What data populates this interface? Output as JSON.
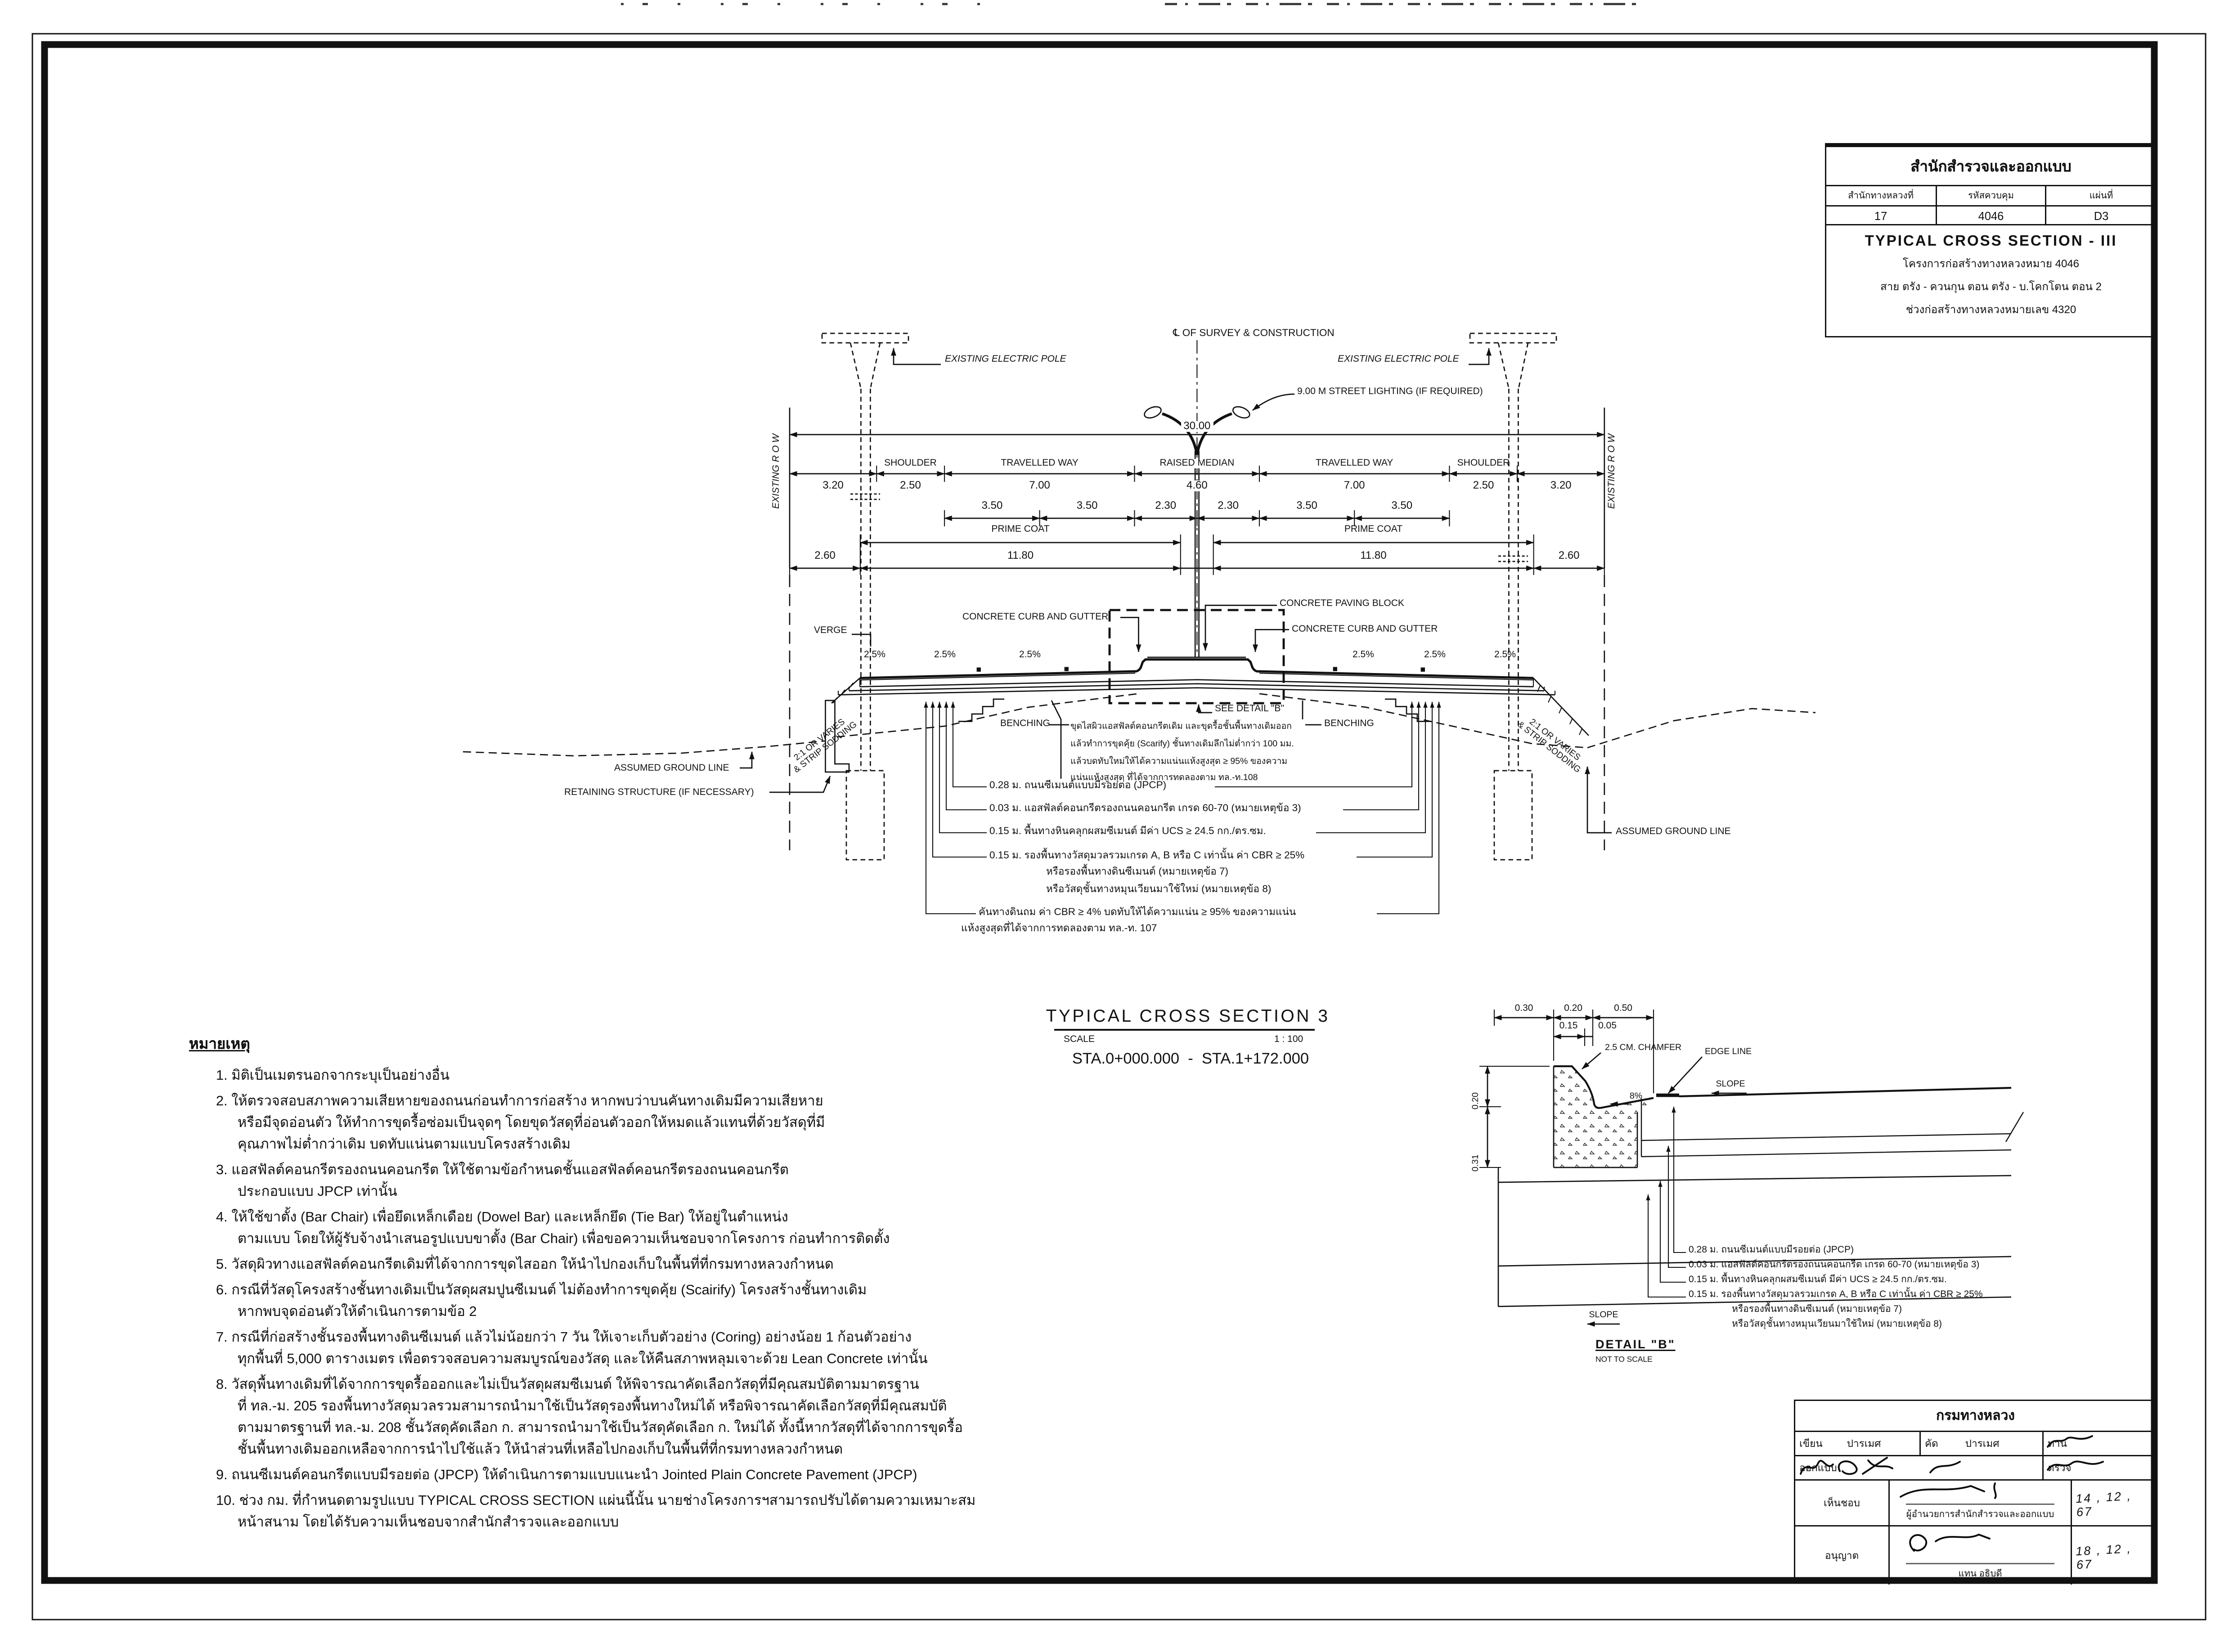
{
  "title_block": {
    "agency": "สำนักสำรวจและออกแบบ",
    "col1_label": "สำนักทางหลวงที่",
    "col1_value": "17",
    "col2_label": "รหัสควบคุม",
    "col2_value": "4046",
    "col3_label": "แผ่นที่",
    "col3_value": "D3",
    "drawing_title": "TYPICAL CROSS SECTION - III",
    "project_line1": "โครงการก่อสร้างทางหลวงหมาย 4046",
    "project_line2": "สาย ตรัง - ควนกุน ตอน ตรัง - บ.โคกโตน ตอน 2",
    "project_line3": "ช่วงก่อสร้างทางหลวงหมายเลข 4320"
  },
  "section": {
    "centerline_label": "℄ OF SURVEY & CONSTRUCTION",
    "row_label": "EXISTING R O W",
    "electric_pole_label": "EXISTING ELECTRIC POLE",
    "street_light_label": "9.00 M STREET LIGHTING (IF REQUIRED)",
    "labels": {
      "shoulder": "SHOULDER",
      "travelled_way": "TRAVELLED WAY",
      "raised_median": "RAISED MEDIAN",
      "prime_coat": "PRIME COAT",
      "verge": "VERGE",
      "benching": "BENCHING",
      "see_detail": "SEE DETAIL \"B\"",
      "slope_2_5": "2.5%",
      "slope_note": "2:1 OR VARIES\n& STRIP SODDING",
      "assumed_ground": "ASSUMED GROUND LINE",
      "retaining": "RETAINING STRUCTURE (IF NECESSARY)",
      "paving_block": "CONCRETE PAVING BLOCK",
      "curb_gutter": "CONCRETE CURB AND GUTTER"
    },
    "dims": {
      "total": "30.00",
      "d320": "3.20",
      "d250": "2.50",
      "d700": "7.00",
      "d460": "4.60",
      "d350": "3.50",
      "d230": "2.30",
      "d260": "2.60",
      "d1180": "11.80"
    },
    "scarify_note": "ขุดไสผิวแอสฟัลต์คอนกรีตเดิม และขุดรื้อชั้นพื้นทางเดิมออก\nแล้วทำการขุดคุ้ย (Scarify) ชั้นทางเดิมลึกไม่ต่ำกว่า 100 มม.\nแล้วบดทับใหม่ให้ได้ความแน่นแห้งสูงสุด ≥ 95% ของความ\nแน่นแห้งสูงสุด ที่ได้จากการทดลองตาม ทล.-ท.108",
    "layers": [
      {
        "d": "0.28 ม.",
        "t": "ถนนซีเมนต์แบบมีรอยต่อ (JPCP)"
      },
      {
        "d": "0.03 ม.",
        "t": "แอสฟัลต์คอนกรีตรองถนนคอนกรีต เกรด 60-70 (หมายเหตุข้อ 3)"
      },
      {
        "d": "0.15 ม.",
        "t": "พื้นทางหินคลุกผสมซีเมนต์ มีค่า UCS ≥ 24.5 กก./ตร.ซม."
      },
      {
        "d": "0.15 ม.",
        "t": "รองพื้นทางวัสดุมวลรวมเกรด A, B หรือ C เท่านั้น ค่า CBR ≥ 25%",
        "t2": "หรือรองพื้นทางดินซีเมนต์ (หมายเหตุข้อ 7)",
        "t3": "หรือวัสดุชั้นทางหมุนเวียนมาใช้ใหม่ (หมายเหตุข้อ 8)"
      },
      {
        "d": "",
        "t": "คันทางดินถม ค่า CBR ≥ 4% บดทับให้ได้ความแน่น ≥ 95% ของความแน่น",
        "t2": "แห้งสูงสุดที่ได้จากการทดลองตาม ทล.-ท. 107"
      }
    ]
  },
  "section_title": {
    "title": "TYPICAL CROSS SECTION 3",
    "scale_label": "SCALE",
    "scale_value": "1 : 100",
    "sta": "STA.0+000.000  -  STA.1+172.000"
  },
  "detail_b": {
    "dims": {
      "d030": "0.30",
      "d020": "0.20",
      "d050": "0.50",
      "d015": "0.15",
      "d005": "0.05",
      "v020": "0.20",
      "v031": "0.31"
    },
    "labels": {
      "chamfer": "2.5 CM. CHAMFER",
      "edge_line": "EDGE LINE",
      "slope": "SLOPE",
      "grade": "8%"
    },
    "name": "DETAIL \"B\"",
    "scale_note": "NOT TO SCALE"
  },
  "notes": {
    "heading": "หมายเหตุ",
    "items": [
      "1. มิติเป็นเมตรนอกจากระบุเป็นอย่างอื่น",
      "2. ให้ตรวจสอบสภาพความเสียหายของถนนก่อนทำการก่อสร้าง หากพบว่าบนคันทางเดิมมีความเสียหาย\nหรือมีจุดอ่อนตัว ให้ทำการขุดรื้อซ่อมเป็นจุดๆ โดยขุดวัสดุที่อ่อนตัวออกให้หมดแล้วแทนที่ด้วยวัสดุที่มี\nคุณภาพไม่ต่ำกว่าเดิม บดทับแน่นตามแบบโครงสร้างเดิม",
      "3. แอสฟัลต์คอนกรีตรองถนนคอนกรีต ให้ใช้ตามข้อกำหนดชั้นแอสฟัลต์คอนกรีตรองถนนคอนกรีต\nประกอบแบบ JPCP เท่านั้น",
      "4. ให้ใช้ขาตั้ง (Bar Chair) เพื่อยึดเหล็กเดือย (Dowel Bar) และเหล็กยึด (Tie Bar) ให้อยู่ในตำแหน่ง\nตามแบบ โดยให้ผู้รับจ้างนำเสนอรูปแบบขาตั้ง (Bar Chair) เพื่อขอความเห็นชอบจากโครงการ ก่อนทำการติดตั้ง",
      "5. วัสดุผิวทางแอสฟัลต์คอนกรีตเดิมที่ได้จากการขุดไสออก ให้นำไปกองเก็บในพื้นที่ที่กรมทางหลวงกำหนด",
      "6. กรณีที่วัสดุโครงสร้างชั้นทางเดิมเป็นวัสดุผสมปูนซีเมนต์ ไม่ต้องทำการขุดคุ้ย (Scairify) โครงสร้างชั้นทางเดิม\nหากพบจุดอ่อนตัวให้ดำเนินการตามข้อ 2",
      "7. กรณีที่ก่อสร้างชั้นรองพื้นทางดินซีเมนต์ แล้วไม่น้อยกว่า 7 วัน ให้เจาะเก็บตัวอย่าง (Coring) อย่างน้อย 1 ก้อนตัวอย่าง\nทุกพื้นที่ 5,000 ตารางเมตร เพื่อตรวจสอบความสมบูรณ์ของวัสดุ และให้คืนสภาพหลุมเจาะด้วย Lean Concrete เท่านั้น",
      "8. วัสดุพื้นทางเดิมที่ได้จากการขุดรื้อออกและไม่เป็นวัสดุผสมซีเมนต์ ให้พิจารณาคัดเลือกวัสดุที่มีคุณสมบัติตามมาตรฐาน\nที่ ทล.-ม. 205 รองพื้นทางวัสดุมวลรวมสามารถนำมาใช้เป็นวัสดุรองพื้นทางใหม่ได้ หรือพิจารณาคัดเลือกวัสดุที่มีคุณสมบัติ\nตามมาตรฐานที่ ทล.-ม. 208 ชั้นวัสดุคัดเลือก ก. สามารถนำมาใช้เป็นวัสดุคัดเลือก ก. ใหม่ได้ ทั้งนี้หากวัสดุที่ได้จากการขุดรื้อ\nชั้นพื้นทางเดิมออกเหลือจากการนำไปใช้แล้ว ให้นำส่วนที่เหลือไปกองเก็บในพื้นที่ที่กรมทางหลวงกำหนด",
      "9. ถนนซีเมนต์คอนกรีตแบบมีรอยต่อ (JPCP) ให้ดำเนินการตามแบบแนะนำ Jointed Plain Concrete Pavement (JPCP)",
      "10. ช่วง กม. ที่กำหนดตามรูปแบบ TYPICAL CROSS SECTION แผ่นนี้นั้น นายช่างโครงการฯสามารถปรับได้ตามความเหมาะสม\nหน้าสนาม โดยได้รับความเห็นชอบจากสำนักสำรวจและออกแบบ"
    ]
  },
  "sig_block": {
    "agency": "กรมทางหลวง",
    "drawn_label": "เขียน",
    "drawn_value": "ปารเมศ",
    "traced_label": "คัด",
    "traced_value": "ปารเมศ",
    "checked_label": "ทาน",
    "designed_label": "ออกแบบ",
    "verified_label": "ตรวจ",
    "approved_label": "เห็นชอบ",
    "approved_title": "ผู้อำนวยการสำนักสำรวจและออกแบบ",
    "approved_date": "14 , 12 , 67",
    "authorized_label": "อนุญาต",
    "authorized_title": "แทน อธิบดี",
    "authorized_date": "18 , 12 , 67"
  }
}
